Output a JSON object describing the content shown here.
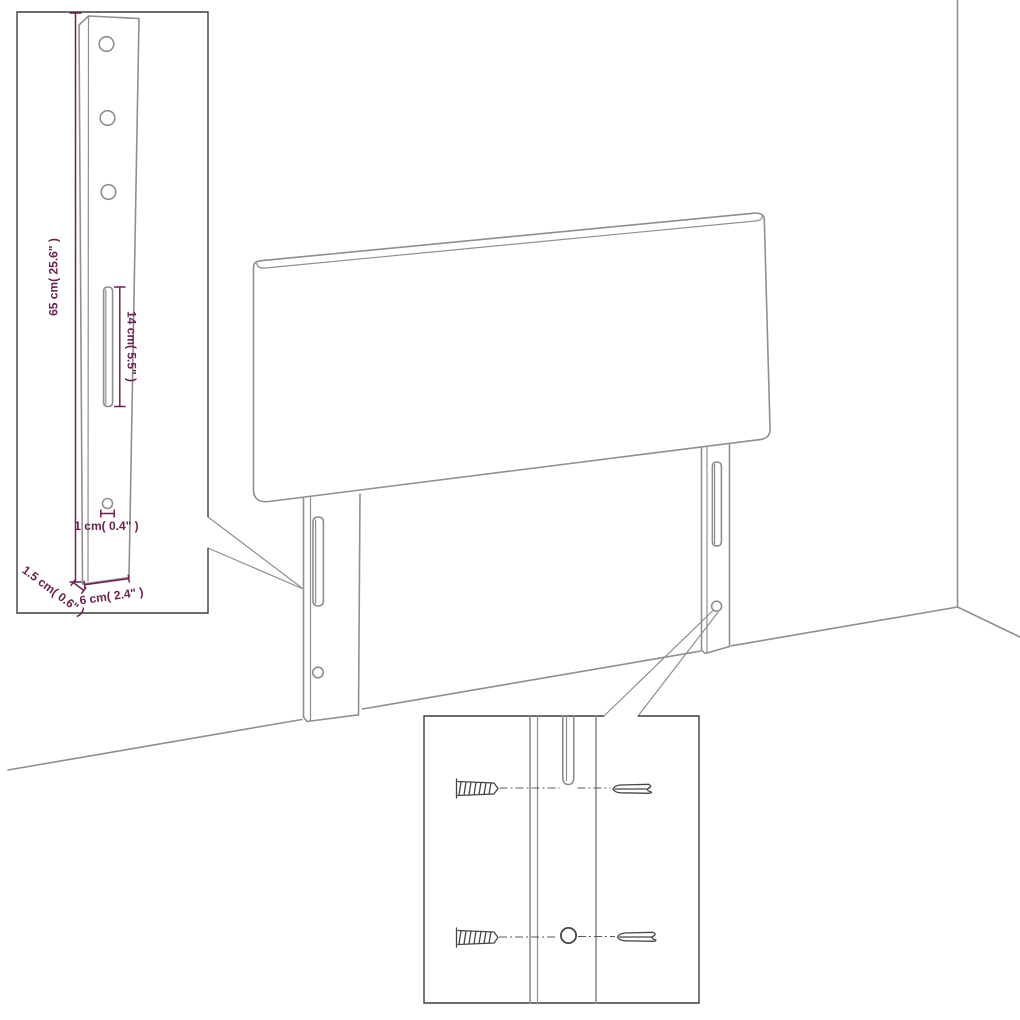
{
  "diagram": {
    "type": "product-dimension-drawing",
    "subject": "upholstered headboard with two mounting legs, shown against a wall corner",
    "insets": {
      "leg_detail": "close-up of full leg post with three holes, long slot and bottom hole",
      "hardware_detail": "close-up of leg slot and hole with wall plugs and screws"
    }
  },
  "labels": {
    "leg_height": "65 cm( 25.6\" )",
    "slot_length": "14 cm( 5.5\" )",
    "hole_diameter": "1 cm( 0.4\" )",
    "leg_thickness": "1.5 cm( 0.6\" )",
    "leg_width": "6 cm( 2.4\" )"
  },
  "colors": {
    "background": "#ffffff",
    "line": "#8f8f8f",
    "inset_border": "#3f3f3f",
    "hardware": "#454545",
    "dimension": "#6d2150"
  }
}
